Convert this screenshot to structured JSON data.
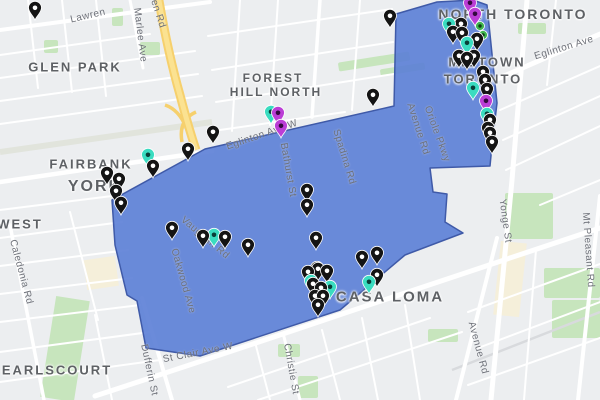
{
  "map": {
    "colors": {
      "background": "#eceef0",
      "road": "#ffffff",
      "park": "#c7e5bd",
      "highway": "#f6d06d",
      "commercial": "#f5efda"
    },
    "overlay": {
      "name": "selected-region",
      "points": "112,200 205,149 394,106 396,14 437,2 473,0 487,5 497,103 492,145 490,166 430,168 433,192 447,194 445,222 463,233 405,255 340,310 200,356 146,348 137,301 127,295 115,245",
      "fill": "#5b7ed6",
      "fill_opacity": "0.9",
      "stroke": "#3f5aa8"
    },
    "pin_colors": {
      "black": {
        "body": "#141414",
        "dot": "#ffffff"
      },
      "teal": {
        "body": "#3adcc0",
        "dot": "#0a3f38"
      },
      "purple": {
        "body": "#bb3ed6",
        "dot": "#32093d"
      },
      "green": {
        "body": "#3fb54e",
        "dot": "#0d3a14"
      }
    },
    "neighborhood_labels": [
      {
        "t": "GLEN PARK",
        "x": 75,
        "y": 67,
        "s": 13
      },
      {
        "t": "FOREST",
        "x": 273,
        "y": 78,
        "s": 12
      },
      {
        "t": "HILL NORTH",
        "x": 276,
        "y": 92,
        "s": 12
      },
      {
        "t": "NORTH TORONTO",
        "x": 513,
        "y": 14,
        "s": 14
      },
      {
        "t": "MIDTOWN",
        "x": 487,
        "y": 62,
        "s": 13
      },
      {
        "t": "TORONTO",
        "x": 483,
        "y": 79,
        "s": 13
      },
      {
        "t": "FAIRBANK",
        "x": 91,
        "y": 164,
        "s": 13
      },
      {
        "t": "YORK",
        "x": 95,
        "y": 187,
        "s": 16
      },
      {
        "t": "WEST",
        "x": 20,
        "y": 224,
        "s": 13
      },
      {
        "t": "EARLSCOURT",
        "x": 57,
        "y": 370,
        "s": 13
      },
      {
        "t": "CASA LOMA",
        "x": 390,
        "y": 297,
        "s": 15
      }
    ],
    "street_labels": [
      {
        "t": "Lawren",
        "x": 88,
        "y": 16,
        "r": -13
      },
      {
        "t": "Marlee Ave",
        "x": 140,
        "y": 35,
        "r": 83
      },
      {
        "t": "en Rd",
        "x": 158,
        "y": 14,
        "r": 72
      },
      {
        "t": "Eglinton Ave W",
        "x": 262,
        "y": 135,
        "r": -19
      },
      {
        "t": "Bathurst St",
        "x": 288,
        "y": 170,
        "r": 80
      },
      {
        "t": "Spadina Rd",
        "x": 344,
        "y": 157,
        "r": 73
      },
      {
        "t": "Eglinton Ave",
        "x": 564,
        "y": 48,
        "r": -17
      },
      {
        "t": "Avenue Rd",
        "x": 418,
        "y": 129,
        "r": 72
      },
      {
        "t": "Oriole Pkwy",
        "x": 437,
        "y": 134,
        "r": 70
      },
      {
        "t": "Yonge St",
        "x": 505,
        "y": 221,
        "r": 82
      },
      {
        "t": "Mt Pleasant Rd",
        "x": 588,
        "y": 250,
        "r": 86
      },
      {
        "t": "Caledonia Rd",
        "x": 21,
        "y": 272,
        "r": 75
      },
      {
        "t": "Vaughan Rd",
        "x": 205,
        "y": 238,
        "r": 40
      },
      {
        "t": "Oakwood Ave",
        "x": 183,
        "y": 281,
        "r": 74
      },
      {
        "t": "Dufferin St",
        "x": 149,
        "y": 370,
        "r": 78
      },
      {
        "t": "St Clair Ave W",
        "x": 198,
        "y": 353,
        "r": -11
      },
      {
        "t": "Christie St",
        "x": 291,
        "y": 369,
        "r": 80
      },
      {
        "t": "Avenue Rd",
        "x": 478,
        "y": 348,
        "r": 75
      }
    ],
    "pins": [
      {
        "x": 35,
        "y": 8,
        "c": "black"
      },
      {
        "x": 390,
        "y": 16,
        "c": "black"
      },
      {
        "x": 373,
        "y": 95,
        "c": "black"
      },
      {
        "x": 213,
        "y": 132,
        "c": "black"
      },
      {
        "x": 188,
        "y": 149,
        "c": "black"
      },
      {
        "x": 153,
        "y": 166,
        "c": "black"
      },
      {
        "x": 107,
        "y": 173,
        "c": "black"
      },
      {
        "x": 119,
        "y": 179,
        "c": "black"
      },
      {
        "x": 116,
        "y": 191,
        "c": "black"
      },
      {
        "x": 121,
        "y": 203,
        "c": "black"
      },
      {
        "x": 172,
        "y": 228,
        "c": "black"
      },
      {
        "x": 203,
        "y": 236,
        "c": "black"
      },
      {
        "x": 225,
        "y": 237,
        "c": "black"
      },
      {
        "x": 248,
        "y": 245,
        "c": "black"
      },
      {
        "x": 307,
        "y": 190,
        "c": "black"
      },
      {
        "x": 307,
        "y": 205,
        "c": "black"
      },
      {
        "x": 316,
        "y": 238,
        "c": "black"
      },
      {
        "x": 317,
        "y": 268,
        "c": "black"
      },
      {
        "x": 362,
        "y": 257,
        "c": "black"
      },
      {
        "x": 377,
        "y": 253,
        "c": "black"
      },
      {
        "x": 377,
        "y": 275,
        "c": "black"
      },
      {
        "x": 308,
        "y": 272,
        "c": "black"
      },
      {
        "x": 318,
        "y": 269,
        "c": "black"
      },
      {
        "x": 327,
        "y": 271,
        "c": "black"
      },
      {
        "x": 313,
        "y": 284,
        "c": "black"
      },
      {
        "x": 321,
        "y": 288,
        "c": "black"
      },
      {
        "x": 315,
        "y": 296,
        "c": "black"
      },
      {
        "x": 323,
        "y": 296,
        "c": "black"
      },
      {
        "x": 318,
        "y": 305,
        "c": "black"
      },
      {
        "x": 461,
        "y": 24,
        "c": "black"
      },
      {
        "x": 453,
        "y": 32,
        "c": "black"
      },
      {
        "x": 462,
        "y": 33,
        "c": "black"
      },
      {
        "x": 477,
        "y": 39,
        "c": "black"
      },
      {
        "x": 459,
        "y": 56,
        "c": "black"
      },
      {
        "x": 467,
        "y": 58,
        "c": "black"
      },
      {
        "x": 474,
        "y": 56,
        "c": "black"
      },
      {
        "x": 483,
        "y": 72,
        "c": "black"
      },
      {
        "x": 485,
        "y": 80,
        "c": "black"
      },
      {
        "x": 487,
        "y": 89,
        "c": "black"
      },
      {
        "x": 490,
        "y": 120,
        "c": "black"
      },
      {
        "x": 488,
        "y": 128,
        "c": "black"
      },
      {
        "x": 490,
        "y": 133,
        "c": "black"
      },
      {
        "x": 492,
        "y": 142,
        "c": "black"
      },
      {
        "x": 148,
        "y": 155,
        "c": "teal"
      },
      {
        "x": 214,
        "y": 235,
        "c": "teal"
      },
      {
        "x": 311,
        "y": 281,
        "c": "teal"
      },
      {
        "x": 330,
        "y": 287,
        "c": "teal"
      },
      {
        "x": 369,
        "y": 282,
        "c": "teal"
      },
      {
        "x": 449,
        "y": 24,
        "c": "teal"
      },
      {
        "x": 467,
        "y": 43,
        "c": "teal"
      },
      {
        "x": 473,
        "y": 88,
        "c": "teal"
      },
      {
        "x": 487,
        "y": 114,
        "c": "teal"
      },
      {
        "x": 271,
        "y": 112,
        "c": "teal"
      },
      {
        "x": 470,
        "y": 3,
        "c": "purple"
      },
      {
        "x": 475,
        "y": 14,
        "c": "purple"
      },
      {
        "x": 486,
        "y": 101,
        "c": "purple"
      },
      {
        "x": 278,
        "y": 113,
        "c": "purple"
      },
      {
        "x": 281,
        "y": 126,
        "c": "purple"
      },
      {
        "x": 480,
        "y": 26,
        "c": "green"
      },
      {
        "x": 483,
        "y": 35,
        "c": "green"
      }
    ]
  }
}
